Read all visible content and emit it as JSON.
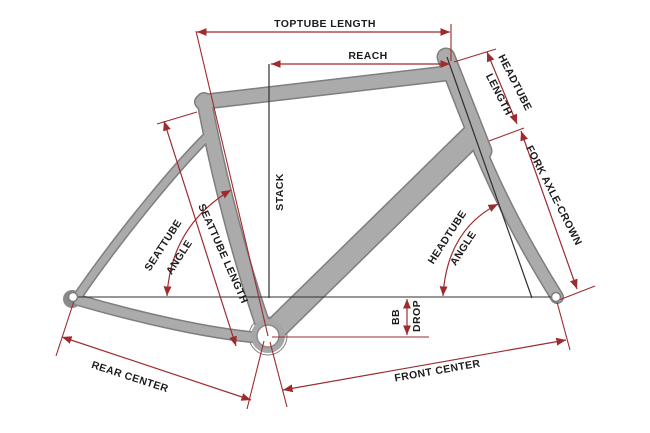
{
  "diagram": {
    "labels": {
      "toptube_length": "TOPTUBE LENGTH",
      "reach": "REACH",
      "stack": "STACK",
      "headtube_length_1": "HEADTUBE",
      "headtube_length_2": "LENGTH",
      "fork_axle_crown": "FORK AXLE-CROWN",
      "seattube_angle_1": "SEATTUBE",
      "seattube_angle_2": "ANGLE",
      "seattube_length": "SEATTUBE LENGTH",
      "headtube_angle_1": "HEADTUBE",
      "headtube_angle_2": "ANGLE",
      "bb": "BB",
      "drop": "DROP",
      "rear_center": "REAR CENTER",
      "front_center": "FRONT CENTER"
    },
    "colors": {
      "dimension": "#9e2b2e",
      "reference": "#2f2f2f",
      "frame_fill": "#ababab",
      "frame_outline": "#7e7e7e",
      "text": "#1c1c1c",
      "background": "#ffffff"
    }
  }
}
